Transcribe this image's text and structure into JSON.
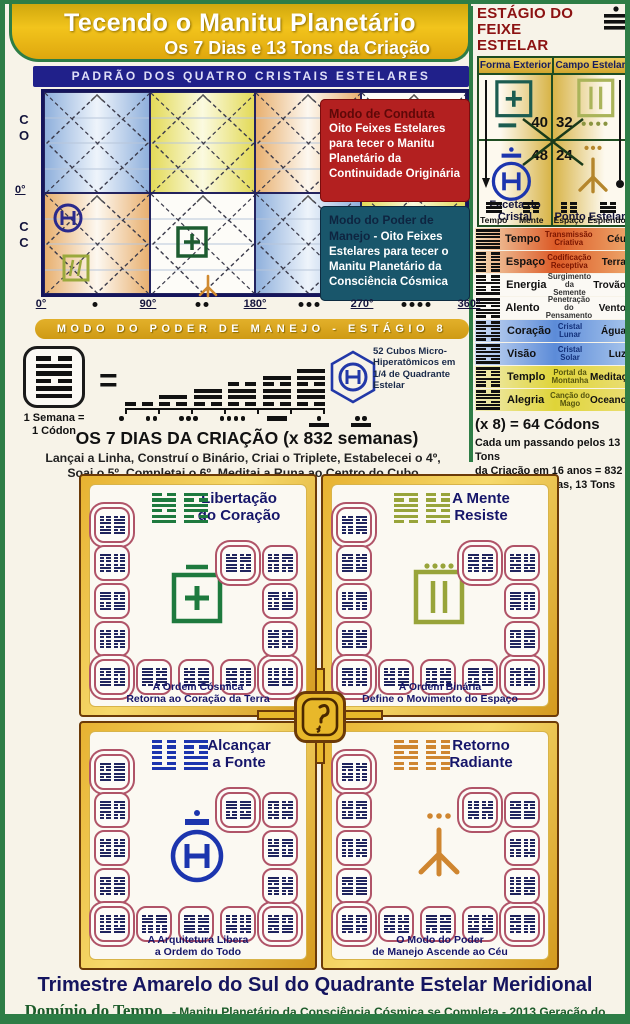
{
  "colors": {
    "frame_green": "#2e7d46",
    "banner_gold": "#e3a81c",
    "navy": "#20208a",
    "red_panel": "#b32020",
    "teal_panel": "#19566b",
    "tile_border": "#b05468"
  },
  "header": {
    "title": "Tecendo o Manitu Planetário",
    "subtitle": "Os 7 Dias e 13 Tons da Criação"
  },
  "stage_panel": {
    "title_line1": "ESTÁGIO DO",
    "title_line2": "FEIXE ESTELAR",
    "col1": "Forma Exterior",
    "col2": "Campo Estelar",
    "num_tl": "40",
    "num_tr": "32",
    "num_bl": "48",
    "num_br": "24",
    "label_bl": "Faceta do Cristal",
    "label_br": "Ponto Estelar"
  },
  "pattern_chart": {
    "title": "PADRÃO DOS QUATRO CRISTAIS ESTELARES",
    "y_top": "C O",
    "y_mid": "0°",
    "y_bottom": "C C",
    "axis_ticks": [
      "0°",
      "90°",
      "180°",
      "270°",
      "360°"
    ],
    "axis_dot_counts": [
      1,
      2,
      3,
      4
    ],
    "columns": [
      {
        "top": "blue",
        "bottom": "orange"
      },
      {
        "top": "yellow",
        "bottom": "white"
      },
      {
        "top": "orange",
        "bottom": "blue"
      },
      {
        "top": "white",
        "bottom": "yellow"
      }
    ],
    "conduct_panel": {
      "title": "Modo de Conduta",
      "body": "Oito Feixes Estelares para tecer o Manitu Planetário da Continuidade Originária"
    },
    "manejo_panel": {
      "title": "Modo do Poder de Manejo",
      "body": " - Oito Feixes Estelares para tecer o Manitu Planetário da Consciência Cósmica"
    }
  },
  "mode_bar": {
    "label": "MODO DO PODER DE MANEJO - ESTÁGIO 8"
  },
  "equation": {
    "codon_label_lines": [
      "1 Semana =",
      "1 Códon"
    ],
    "equals": "=",
    "day_numbers": [
      1,
      2,
      3,
      4,
      5,
      6,
      7
    ],
    "cubes_label": "52 Cubos Micro-Hiperatômicos em 1/4 de Quadrante Estelar",
    "title": "OS 7 DIAS DA CRIAÇÃO (x 832 semanas)",
    "line1": "Lançai a Linha, Construí o Binário, Criai o Triplete, Estabelecei o 4º,",
    "line2": "Soai o 5º, Completai o 6º, Meditai a Runa ao Centro do Cubo"
  },
  "dims_header": [
    {
      "label": "Tempo",
      "trigram": [
        1,
        1,
        1
      ]
    },
    {
      "label": "Mente",
      "trigram": [
        1,
        0,
        0
      ]
    },
    {
      "label": "Espaço",
      "trigram": [
        0,
        0,
        0
      ]
    },
    {
      "label": "Esplendor",
      "trigram": [
        0,
        1,
        1
      ]
    }
  ],
  "dims_table": {
    "rows": [
      {
        "name": "Tempo",
        "quality": "Transmissão Criativa",
        "element": "Céu",
        "group": "fire",
        "hex": [
          1,
          1,
          1,
          1,
          1,
          1
        ]
      },
      {
        "name": "Espaço",
        "quality": "Codificação Receptiva",
        "element": "Terra",
        "group": "fire",
        "hex": [
          0,
          0,
          0,
          0,
          0,
          0
        ]
      },
      {
        "name": "Energia",
        "quality": "Surgimento da Semente",
        "element": "Trovão",
        "group": "white",
        "hex": [
          0,
          0,
          1,
          0,
          0,
          1
        ]
      },
      {
        "name": "Alento",
        "quality": "Penetração do Pensamento",
        "element": "Vento",
        "group": "white",
        "hex": [
          1,
          1,
          0,
          1,
          1,
          0
        ]
      },
      {
        "name": "Coração",
        "quality": "Cristal Lunar",
        "element": "Água",
        "group": "water",
        "hex": [
          0,
          1,
          0,
          0,
          1,
          0
        ]
      },
      {
        "name": "Visão",
        "quality": "Cristal Solar",
        "element": "Luz",
        "group": "water",
        "hex": [
          1,
          0,
          1,
          1,
          0,
          1
        ]
      },
      {
        "name": "Templo",
        "quality": "Portal da Montanha",
        "element": "Meditação",
        "group": "earth",
        "hex": [
          1,
          0,
          0,
          1,
          0,
          0
        ]
      },
      {
        "name": "Alegria",
        "quality": "Canção do Mago",
        "element": "Oceano",
        "group": "earth",
        "hex": [
          0,
          1,
          1,
          0,
          1,
          1
        ]
      }
    ]
  },
  "codons_note": {
    "headline": "(x 8) = 64 Códons",
    "lines": [
      "Cada um passando pelos 13 Tons",
      "da Criação em 16 anos = 832",
      "Códons, 64 Runas, 13 Tons Cada"
    ]
  },
  "quadrants": [
    {
      "id": "nw",
      "title_lines": [
        "Libertação",
        "do Coração"
      ],
      "caption_lines": [
        "A Ordem Cósmica",
        "Retorna ao Coração da Terra"
      ],
      "accent": "#1e7a3e",
      "seal": "plus-square",
      "tons": 13
    },
    {
      "id": "ne",
      "title_lines": [
        "A Mente",
        "Resiste"
      ],
      "caption_lines": [
        "A Ordem Binária",
        "Define o Movimento do Espaço"
      ],
      "accent": "#98a43a",
      "seal": "binary-square",
      "tons": 13
    },
    {
      "id": "sw",
      "title_lines": [
        "Alcançar",
        "a Fonte"
      ],
      "caption_lines": [
        "A Arquitetura Libera",
        "a Ordem do Todo"
      ],
      "accent": "#1c35ae",
      "seal": "crown-circle-h",
      "tons": 13
    },
    {
      "id": "se",
      "title_lines": [
        "Retorno",
        "Radiante"
      ],
      "caption_lines": [
        "O Modo do Poder",
        "de Manejo Ascende ao Céu"
      ],
      "accent": "#cf8630",
      "seal": "bird-foot",
      "tons": 13
    }
  ],
  "footer": {
    "title": "Trimestre Amarelo do Sul do Quadrante Estelar Meridional",
    "domain": "Domínio do Tempo",
    "tagline": "- Manitu Planetário da Consciência Cósmica se Completa - 2013 Geração do Cérebro Galáctico 1320"
  }
}
